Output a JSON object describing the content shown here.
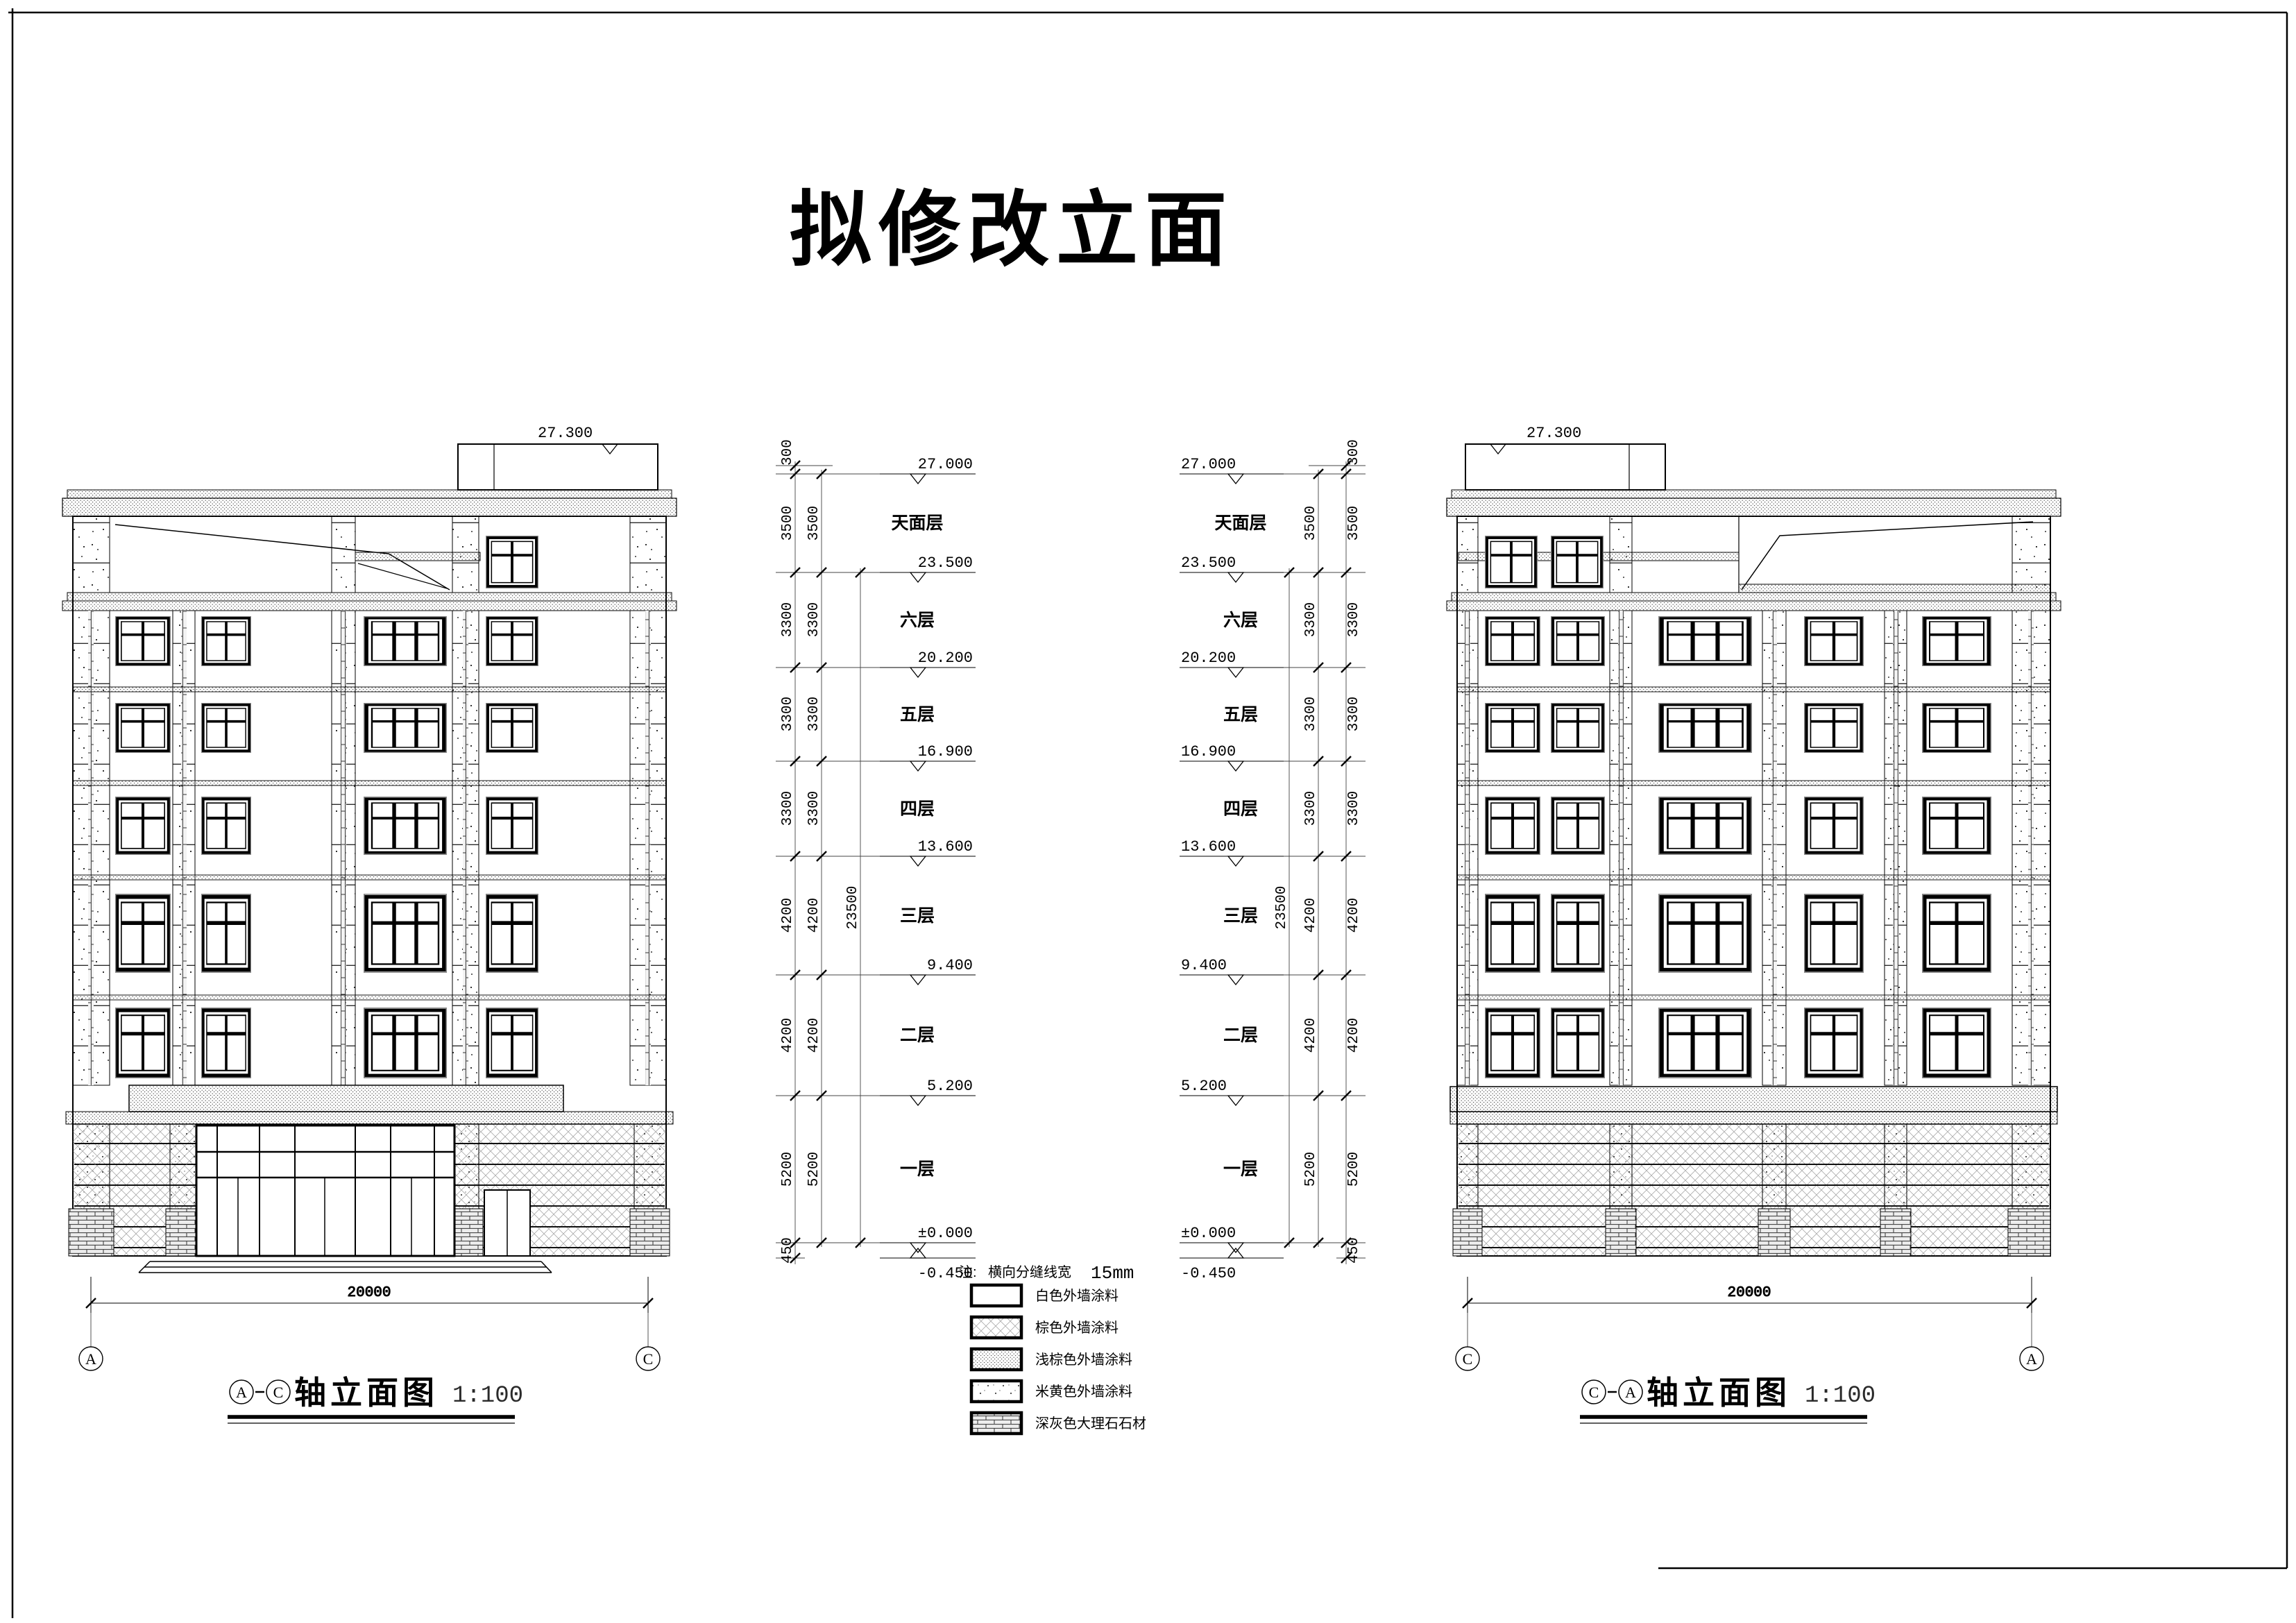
{
  "title": "拟修改立面",
  "elevation_mark": "27.300",
  "span": "20000",
  "axes": {
    "a": "A",
    "c": "C"
  },
  "ruler": {
    "dims_outer": [
      "300",
      "3500",
      "3300",
      "3300",
      "3300",
      "4200",
      "4200",
      "5200",
      "450"
    ],
    "dims_inner": [
      "3500",
      "3300",
      "3300",
      "3300",
      "4200",
      "4200",
      "5200"
    ],
    "overall": "23500",
    "levels": [
      "27.000",
      "23.500",
      "20.200",
      "16.900",
      "13.600",
      "9.400",
      "5.200",
      "±0.000",
      "-0.450"
    ],
    "floors": [
      "天面层",
      "六层",
      "五层",
      "四层",
      "三层",
      "二层",
      "一层"
    ]
  },
  "captions": {
    "left": {
      "axis_from": "A",
      "axis_to": "C",
      "text": "轴立面图",
      "scale": "1:100"
    },
    "right": {
      "axis_from": "C",
      "axis_to": "A",
      "text": "轴立面图",
      "scale": "1:100"
    }
  },
  "legend": {
    "note_label": "注:",
    "note_text": "横向分缝线宽",
    "note_value": "15mm",
    "items": [
      {
        "swatch": "white",
        "label": "白色外墙涂料"
      },
      {
        "swatch": "crosshatch",
        "label": "棕色外墙涂料"
      },
      {
        "swatch": "stipple-dense",
        "label": "浅棕色外墙涂料"
      },
      {
        "swatch": "stipple-sparse",
        "label": "米黄色外墙涂料"
      },
      {
        "swatch": "brick",
        "label": "深灰色大理石石材"
      }
    ]
  }
}
